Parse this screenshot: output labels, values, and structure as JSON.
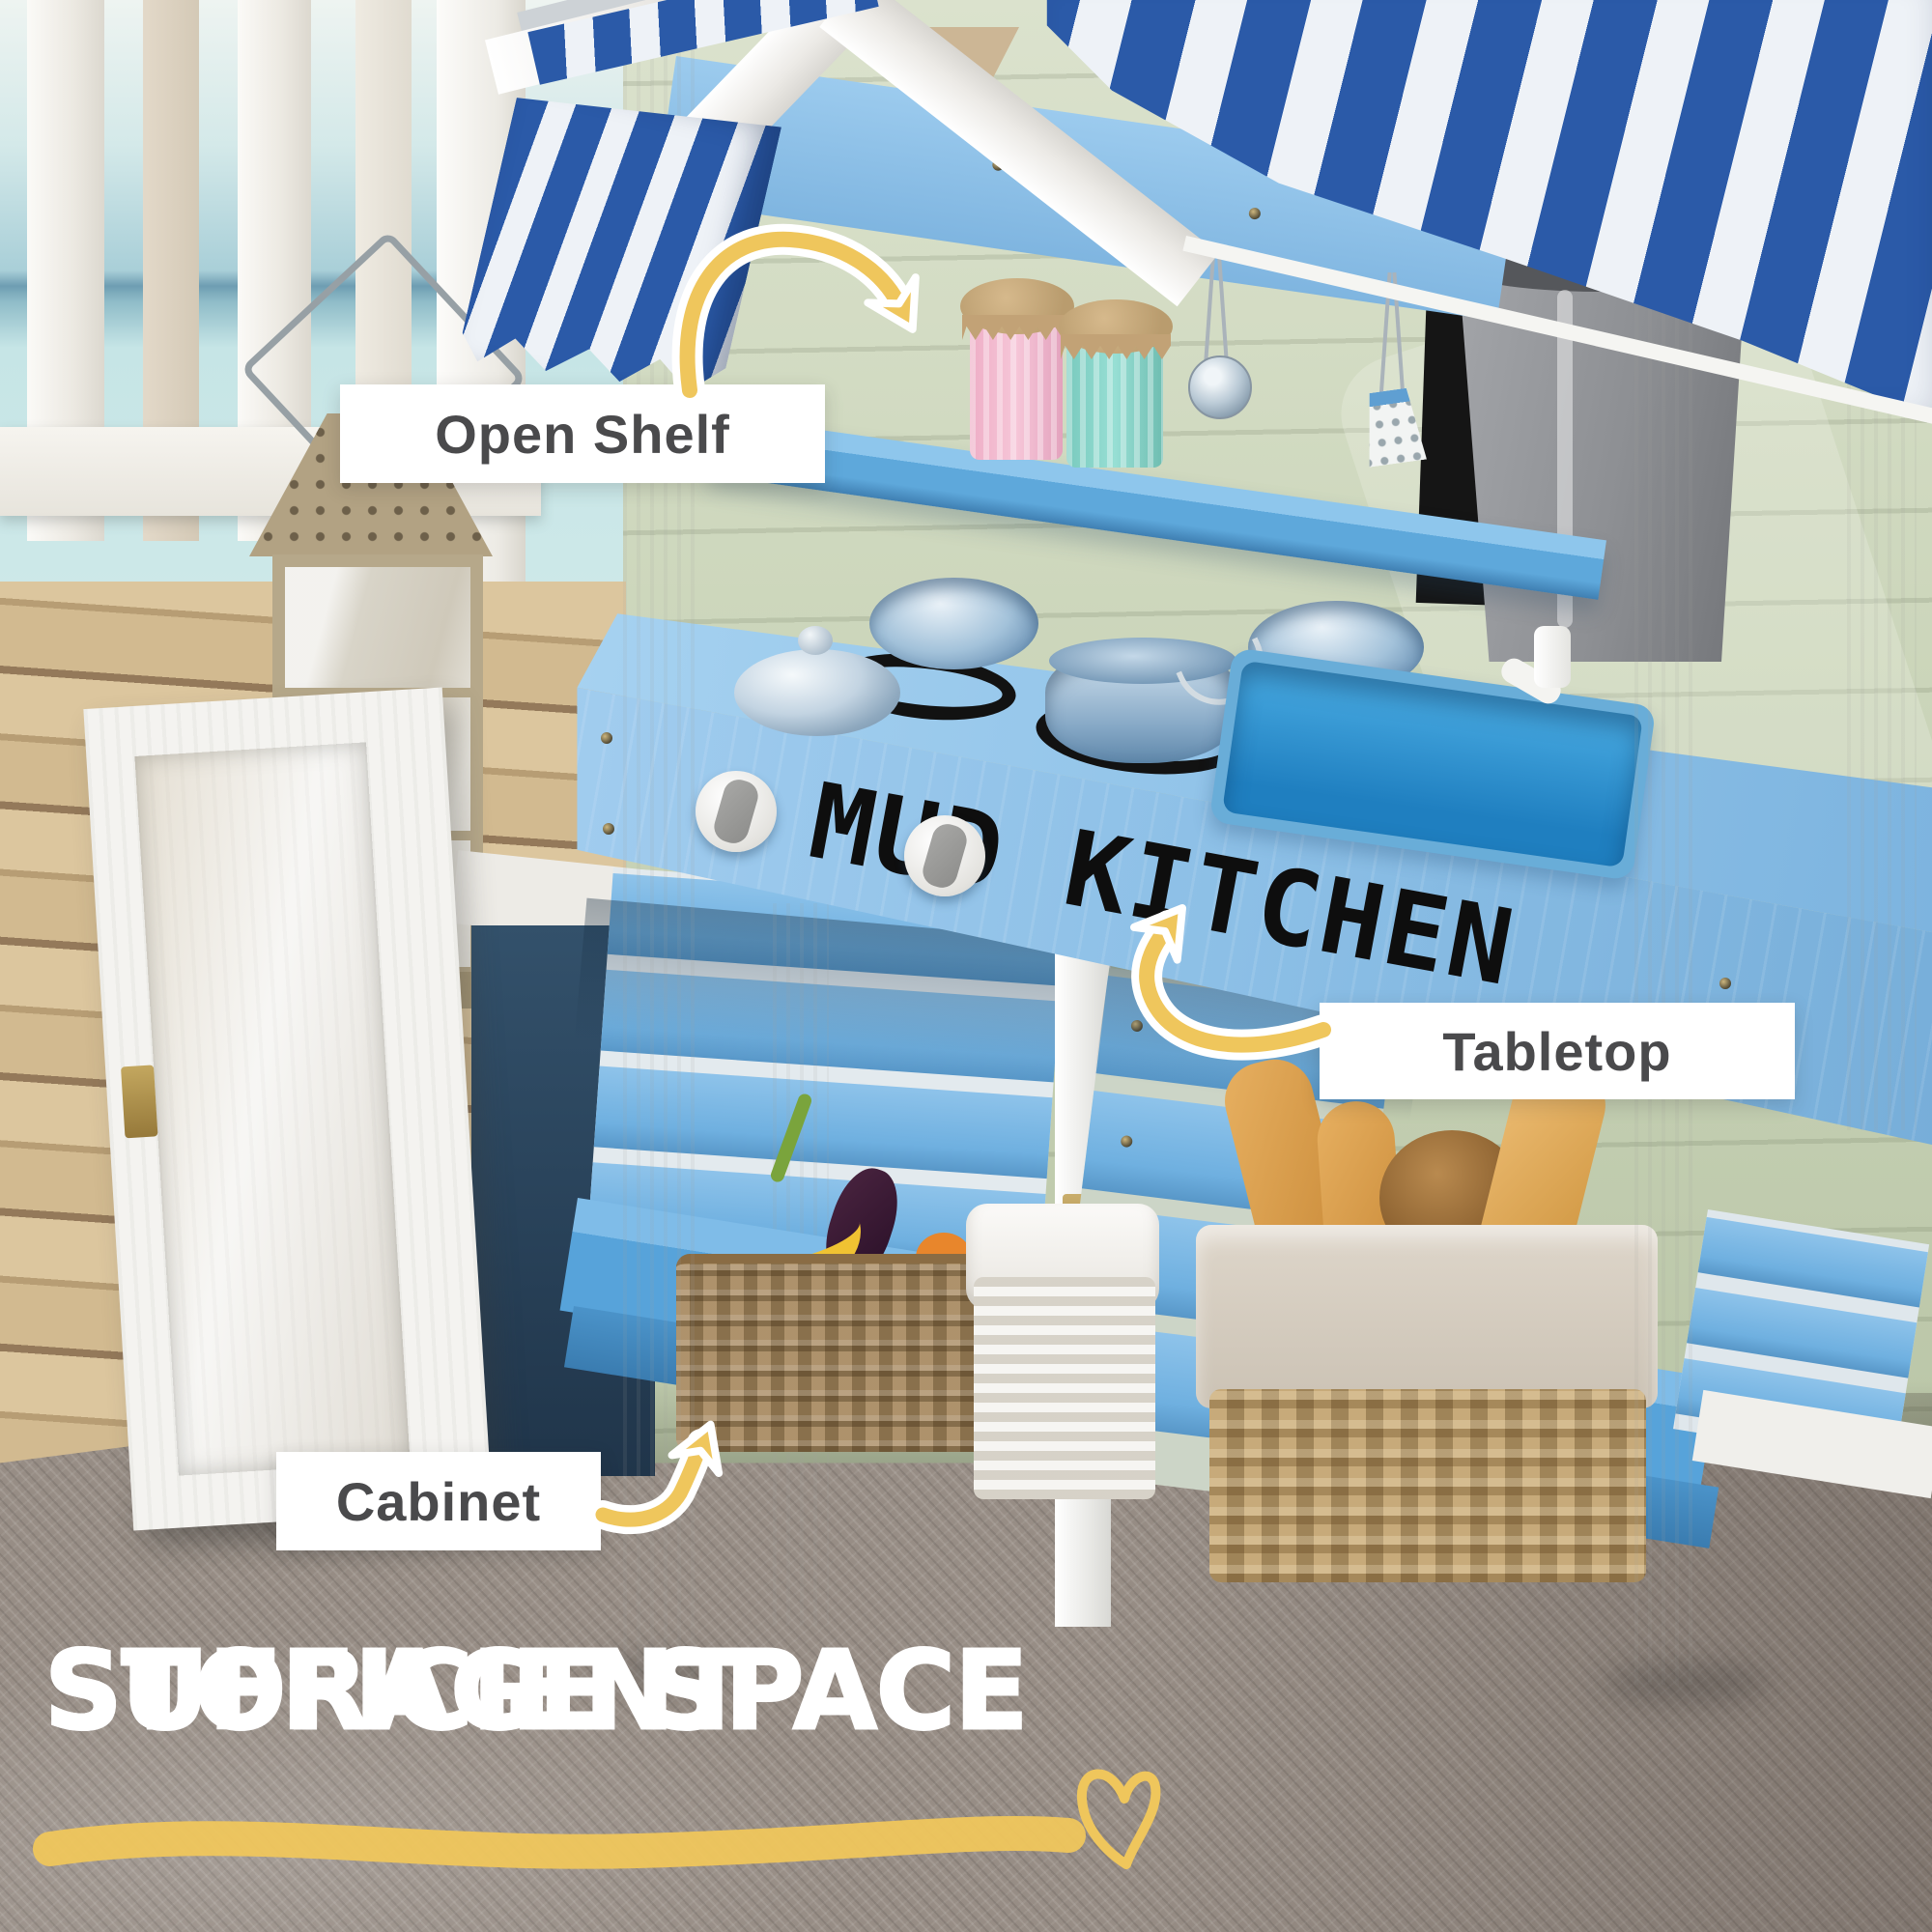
{
  "annotations": {
    "open_shelf": {
      "label": "Open Shelf"
    },
    "tabletop": {
      "label": "Tabletop"
    },
    "cabinet": {
      "label": "Cabinet"
    }
  },
  "heading": {
    "line1": "SUFFICIENT",
    "line2": "STORAGE SPACE"
  },
  "product": {
    "front_text": "MUD KITCHEN"
  },
  "colors": {
    "accent_yellow": "#efc65c",
    "awning_blue": "#2b5aa8",
    "wood_blue": "#8fc3e9",
    "sink_blue": "#1f7fc0",
    "wall_green": "#c9d3b8",
    "label_text": "#4a4a4c",
    "heading_text": "#ffffff",
    "stencil_black": "#0e0e0e"
  },
  "icons": [
    "curved-arrow-icon",
    "heart-doodle-icon",
    "underline-stroke-icon"
  ]
}
